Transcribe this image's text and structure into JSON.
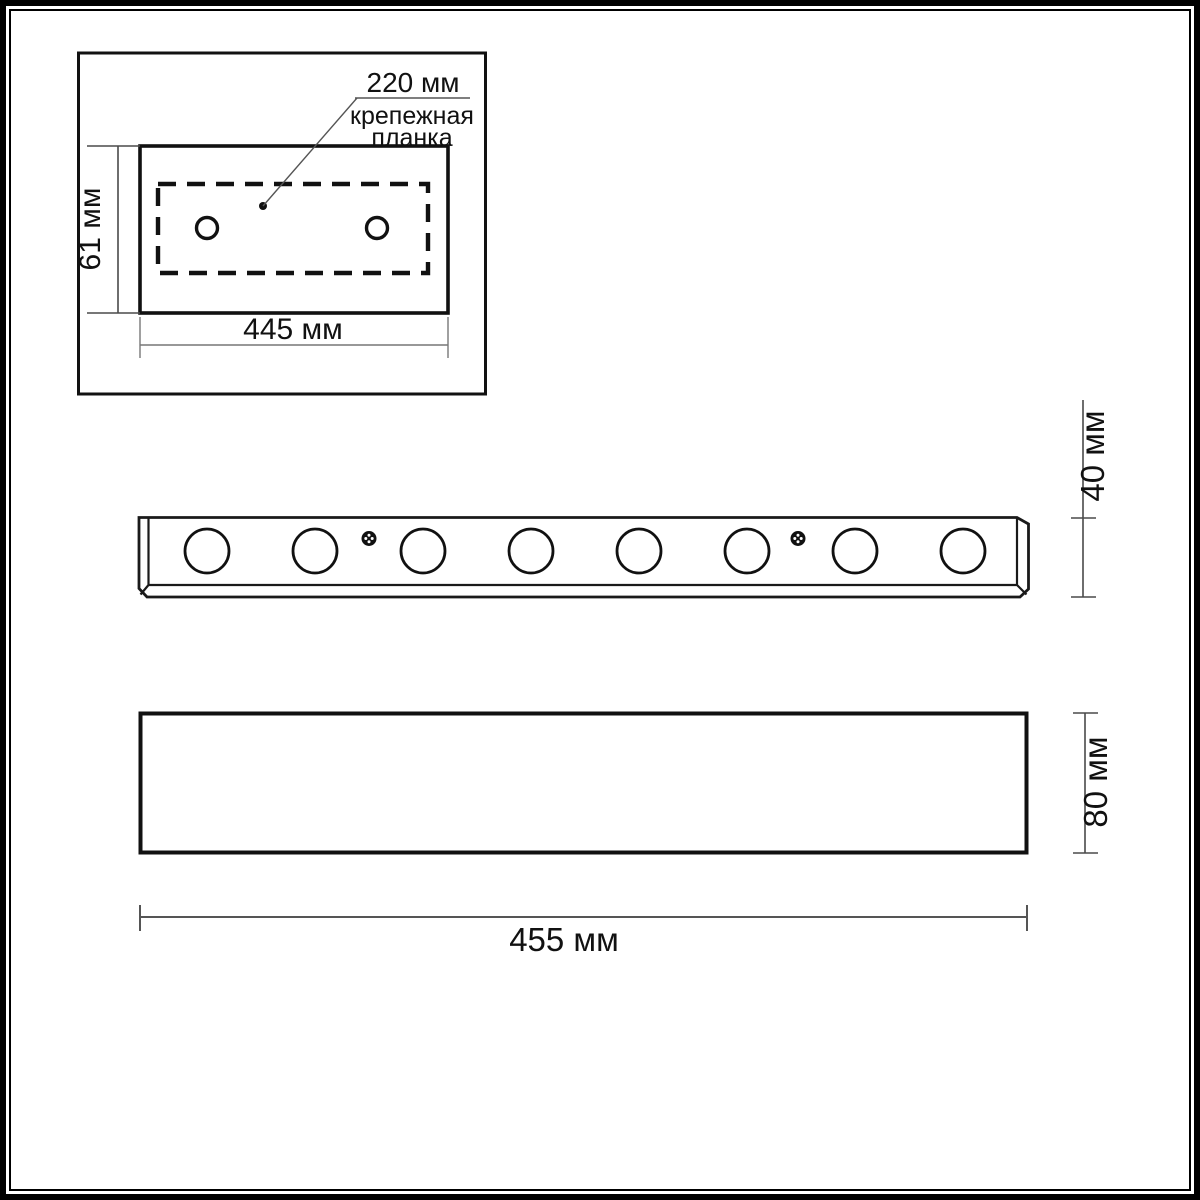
{
  "page": {
    "background_color": "#ffffff",
    "line_color": "#1a1a1a",
    "dimension_line_color": "#555555"
  },
  "mounting_plate_view": {
    "callout_dimension": "220 мм",
    "callout_label_line1": "крепежная",
    "callout_label_line2": "планка",
    "height_dimension": "61 мм",
    "width_dimension": "445 мм",
    "hole_count": 2
  },
  "bottom_view": {
    "depth_dimension": "40 мм",
    "spot_count": 8,
    "screw_count": 2
  },
  "front_view": {
    "height_dimension": "80 мм",
    "width_dimension": "455 мм"
  }
}
